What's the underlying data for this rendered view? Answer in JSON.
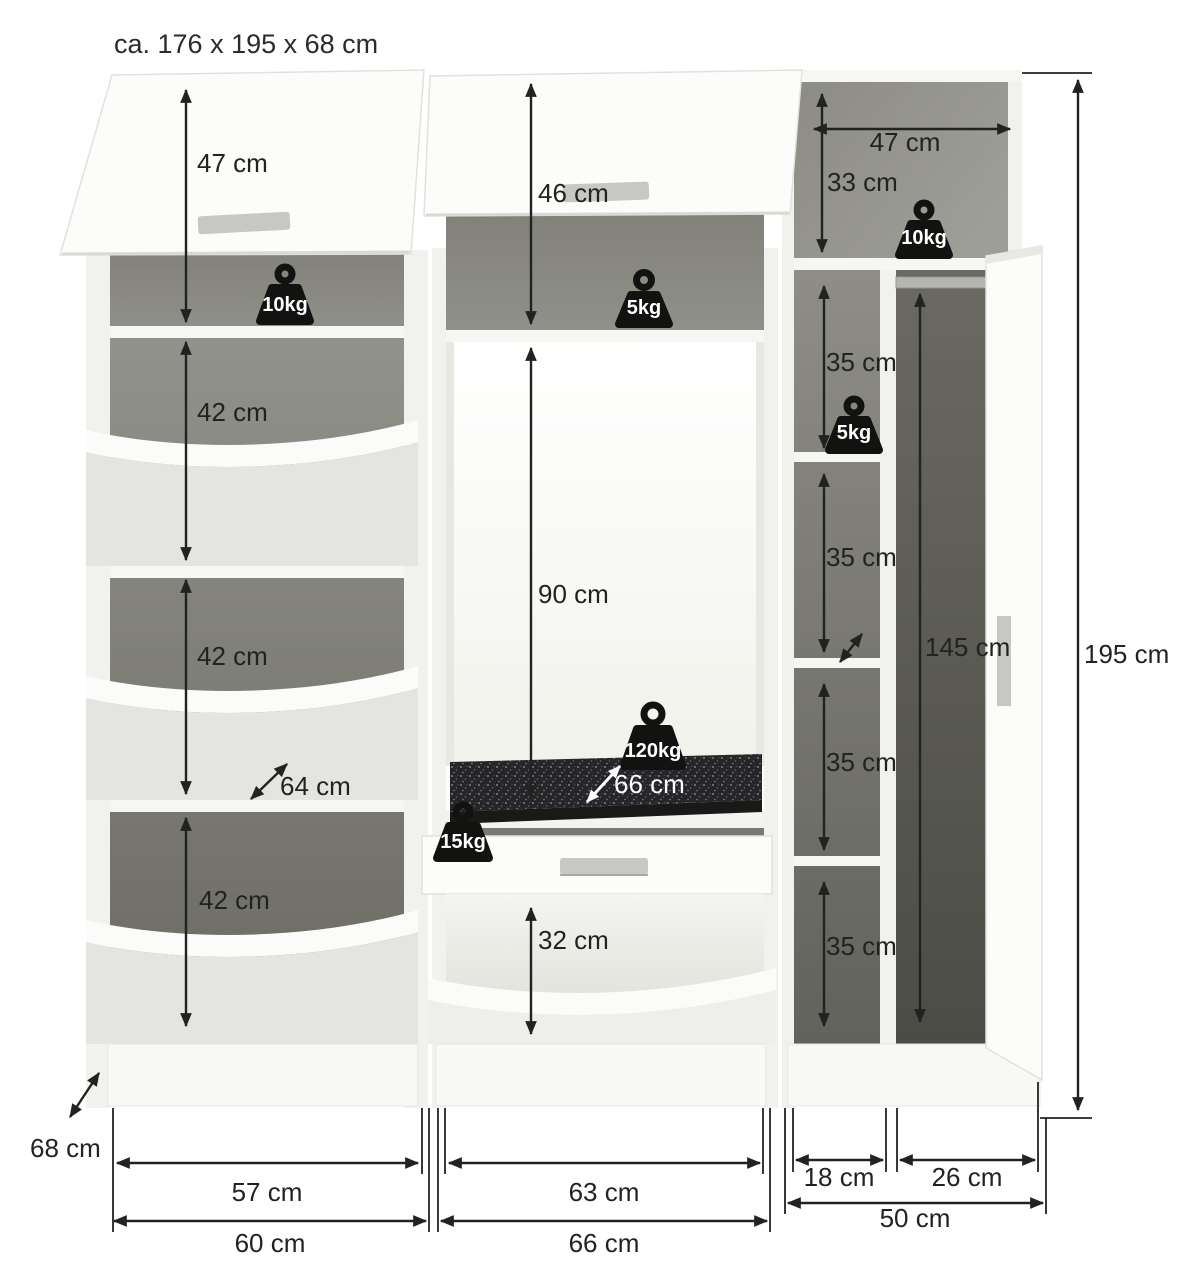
{
  "title": "ca. 176 x 195 x 68 cm",
  "overall": {
    "height": "195 cm",
    "depth": "68 cm"
  },
  "left": {
    "flap_height": "47 cm",
    "load_top": "10kg",
    "comp1_height": "42 cm",
    "comp2_height": "42 cm",
    "comp3_height": "42 cm",
    "comp_depth": "64 cm",
    "inner_width": "57 cm",
    "outer_width": "60 cm"
  },
  "middle": {
    "flap_height": "46 cm",
    "load_shelf": "5kg",
    "niche_height": "90 cm",
    "load_seat": "120kg",
    "seat_depth": "66 cm",
    "load_drawer": "15kg",
    "comp_height": "32 cm",
    "inner_width": "63 cm",
    "outer_width": "66 cm"
  },
  "right": {
    "top_width": "47 cm",
    "top_height": "33 cm",
    "load_top": "10kg",
    "shelf1_height": "35 cm",
    "load_shelf": "5kg",
    "shelf2_height": "35 cm",
    "shelf3_height": "35 cm",
    "shelf4_height": "35 cm",
    "rod_height": "145 cm",
    "niche_left_width": "18 cm",
    "niche_right_width": "26 cm",
    "outer_width": "50 cm"
  }
}
